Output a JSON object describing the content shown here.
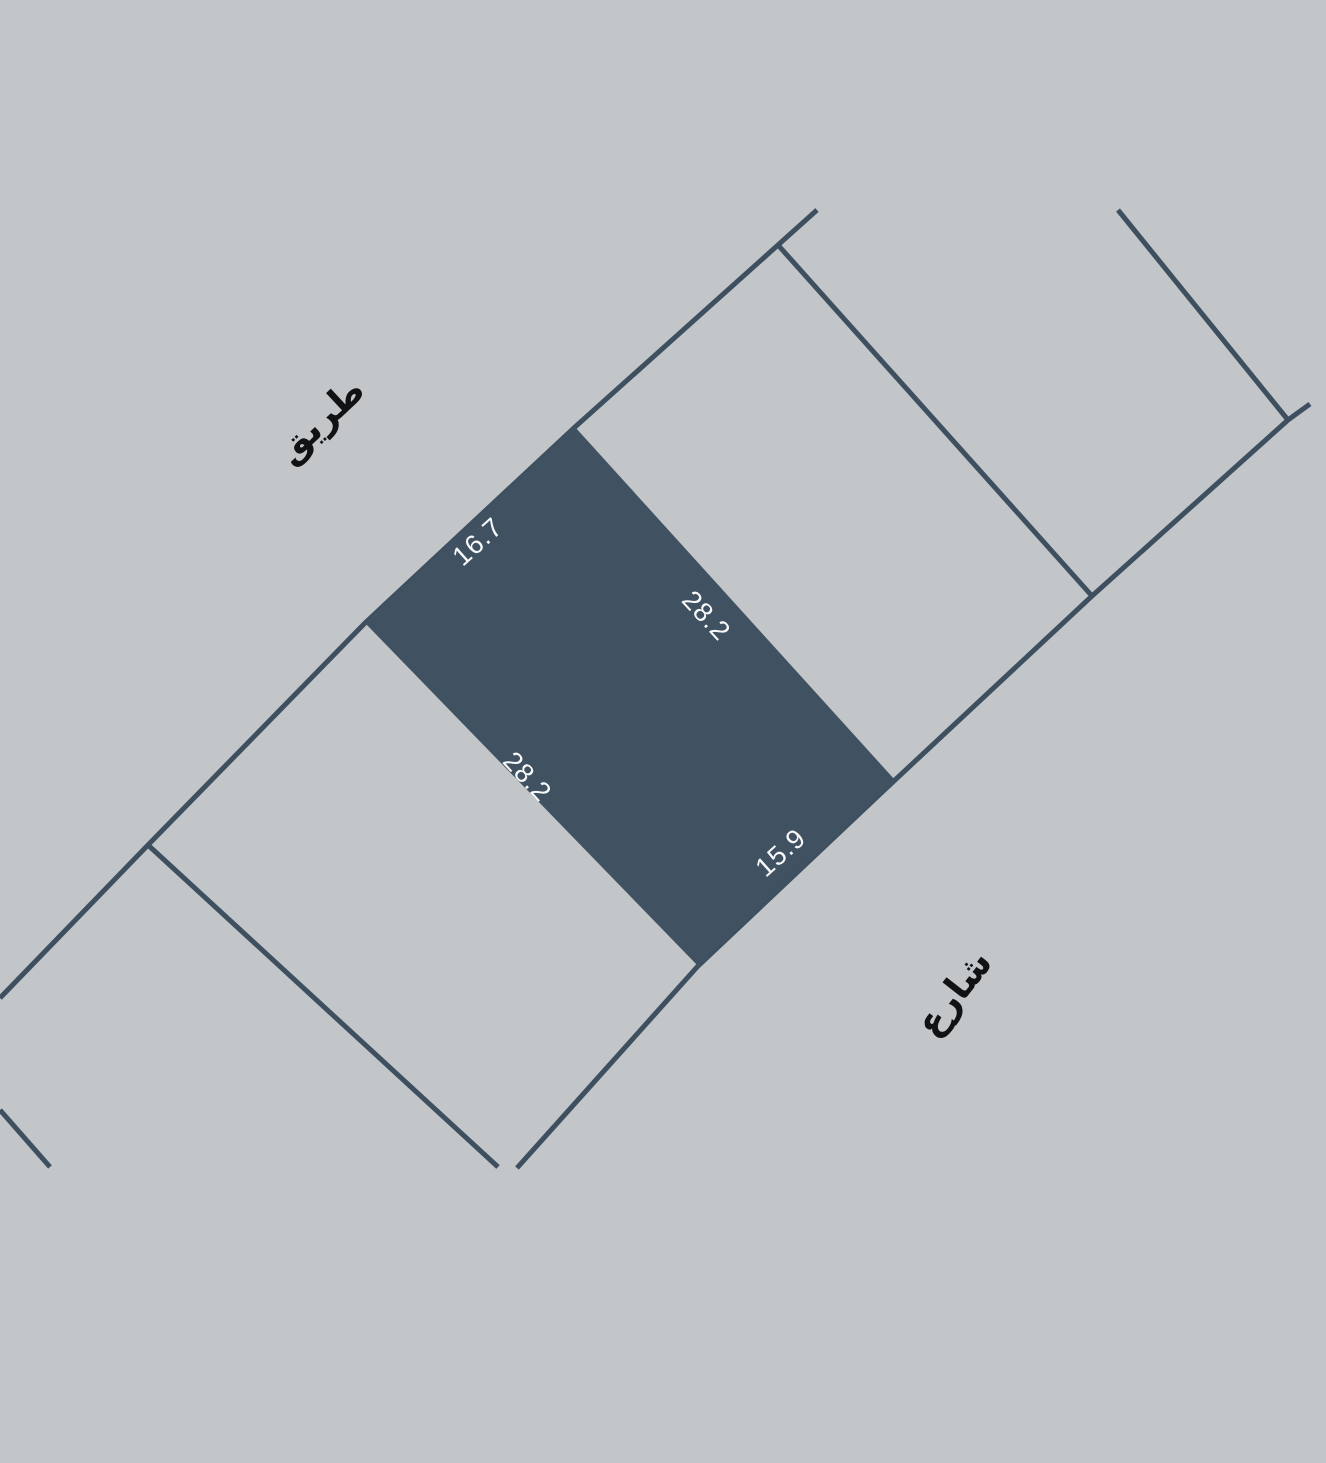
{
  "map": {
    "type": "cadastral-parcel-map",
    "labels": {
      "road": "طريق",
      "street": "شارع"
    },
    "selected_parcel": {
      "dimensions": {
        "top_left_edge": "16.7",
        "top_right_edge": "28.2",
        "bottom_left_edge": "28.2",
        "bottom_right_edge": "15.9"
      }
    },
    "colors": {
      "background": "#c2c6c9",
      "parcel_fill": "#405161",
      "boundary_line": "#3e4f5f",
      "dimension_text": "#f7f9fa",
      "street_label_text": "#101214"
    }
  }
}
